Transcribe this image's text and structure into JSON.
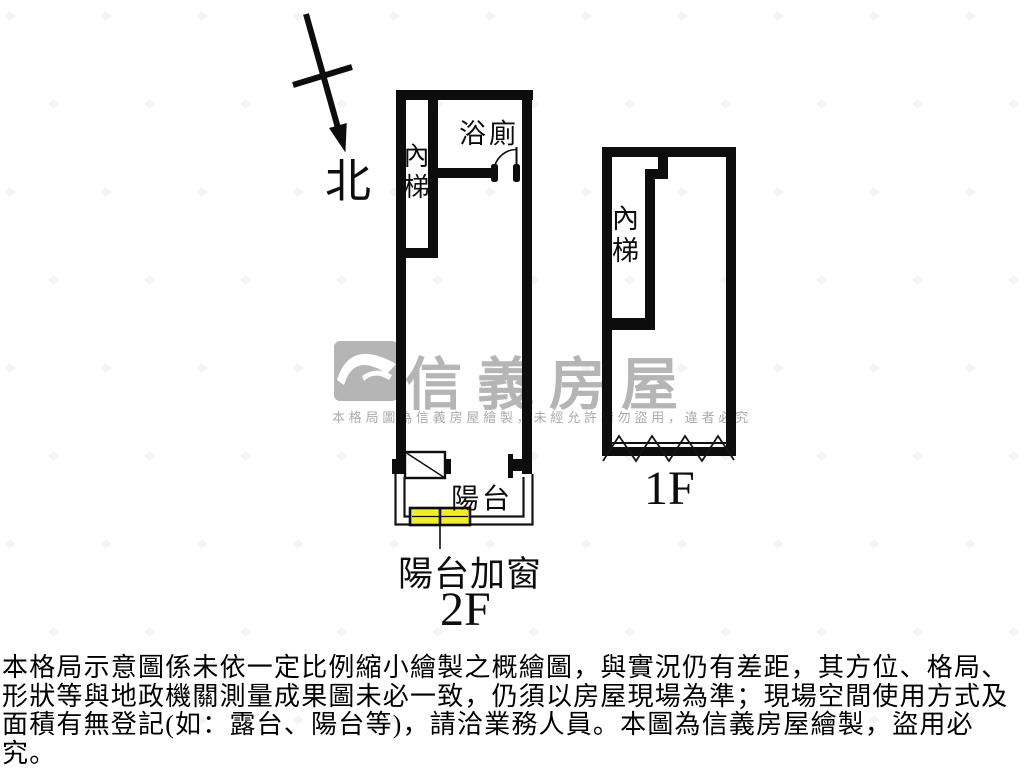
{
  "compass": {
    "north_label": "北"
  },
  "floor_plans": {
    "f2": {
      "floor_label": "2F",
      "stairs_label": "內梯",
      "bathroom_label": "浴廁",
      "balcony_label": "陽台",
      "balcony_window_label": "陽台加窗",
      "added_window_color": "#f1ee28"
    },
    "f1": {
      "floor_label": "1F",
      "stairs_label": "內梯"
    }
  },
  "watermark": {
    "brand": "信義房屋",
    "notice": "本格局圖為信義房屋繪製，未經允許請勿盜用，違者必究",
    "brand_color": "#b5b5b5"
  },
  "disclaimer": {
    "lines": [
      "本格局示意圖係未依一定比例縮小繪製之概繪圖，與實況仍有差距，其方位、格局、",
      "形狀等與地政機關測量成果圖未必一致，仍須以房屋現場為準；現場空間使用方式及",
      "面積有無登記(如：露台、陽台等)，請洽業務人員。本圖為信義房屋繪製，盜用必究。"
    ]
  },
  "colors": {
    "wall": "#0d0d0d",
    "watermark_gray": "#b5b5b5"
  }
}
